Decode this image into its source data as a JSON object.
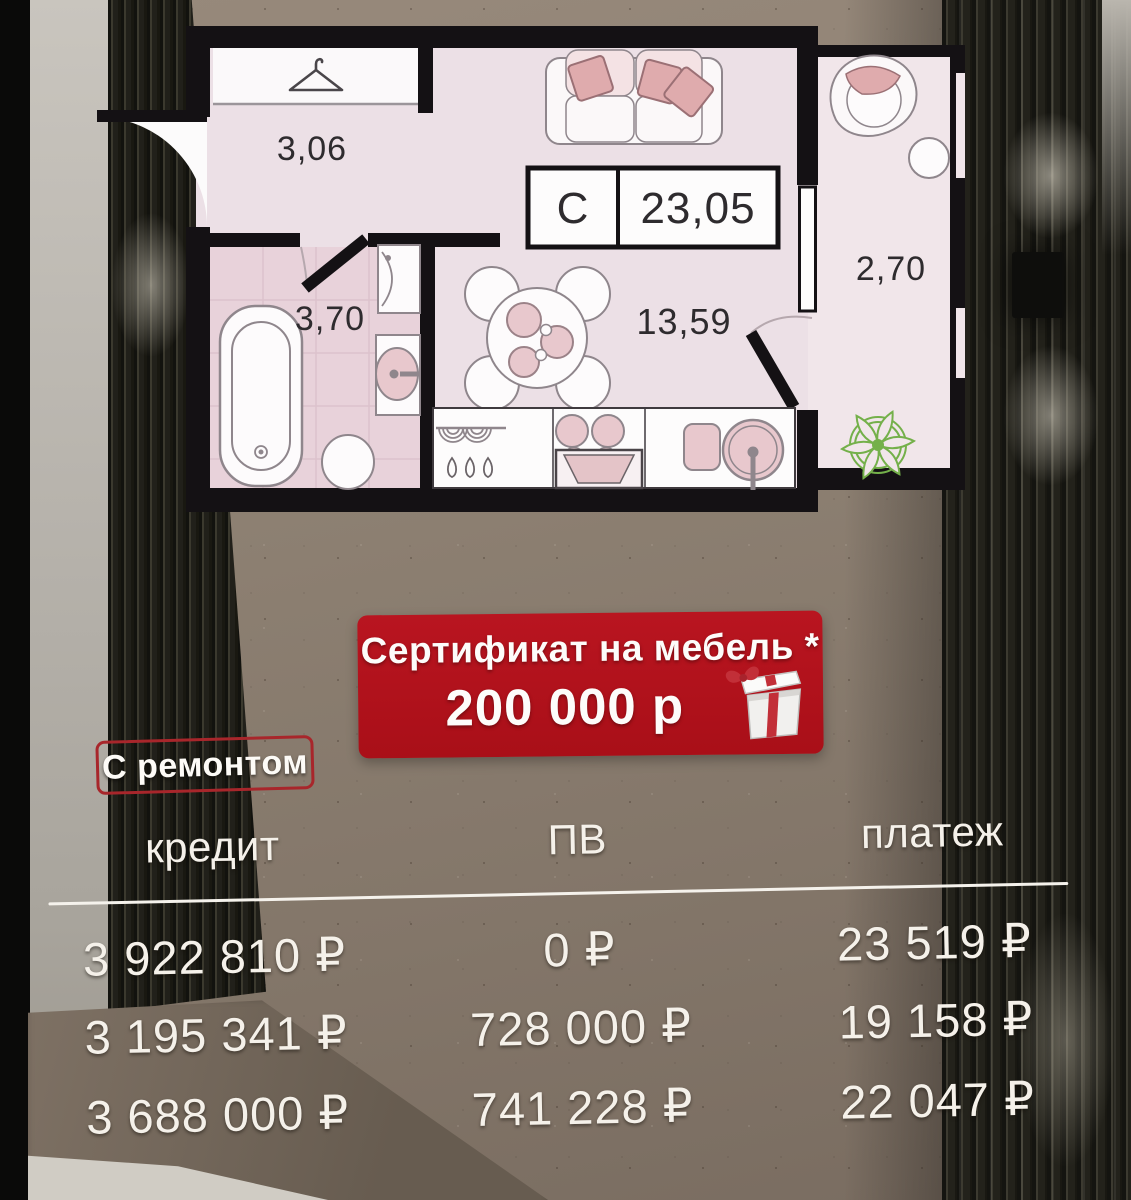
{
  "palette": {
    "accent_red": "#b11119",
    "badge_border_red": "#a8262b",
    "plan_pink": "#ece0e6",
    "text_light": "#f5f1ea"
  },
  "floor_plan": {
    "type_label": "С",
    "total_area": "23,05",
    "rooms": {
      "hallway": "3,06",
      "bathroom": "3,70",
      "living_kitchen": "13,59",
      "balcony": "2,70"
    },
    "icons": [
      "hanger-icon",
      "sofa",
      "dining-table",
      "bathtub",
      "sink",
      "toilet",
      "washer",
      "stove",
      "kitchen-sink",
      "armchair",
      "plant"
    ]
  },
  "promo_banner": {
    "title": "Сертификат на мебель *",
    "amount": "200 000 р",
    "icon": "gift-box-icon"
  },
  "condition_badge": {
    "label": "С ремонтом"
  },
  "payment_table": {
    "headers": [
      "кредит",
      "ПВ",
      "платеж"
    ],
    "rows": [
      {
        "credit": "3 922 810 ₽",
        "down_payment": "0 ₽",
        "payment": "23 519 ₽"
      },
      {
        "credit": "3 195 341 ₽",
        "down_payment": "728 000 ₽",
        "payment": "19 158 ₽"
      },
      {
        "credit": "3 688 000 ₽",
        "down_payment": "741 228 ₽",
        "payment": "22 047 ₽"
      }
    ]
  }
}
